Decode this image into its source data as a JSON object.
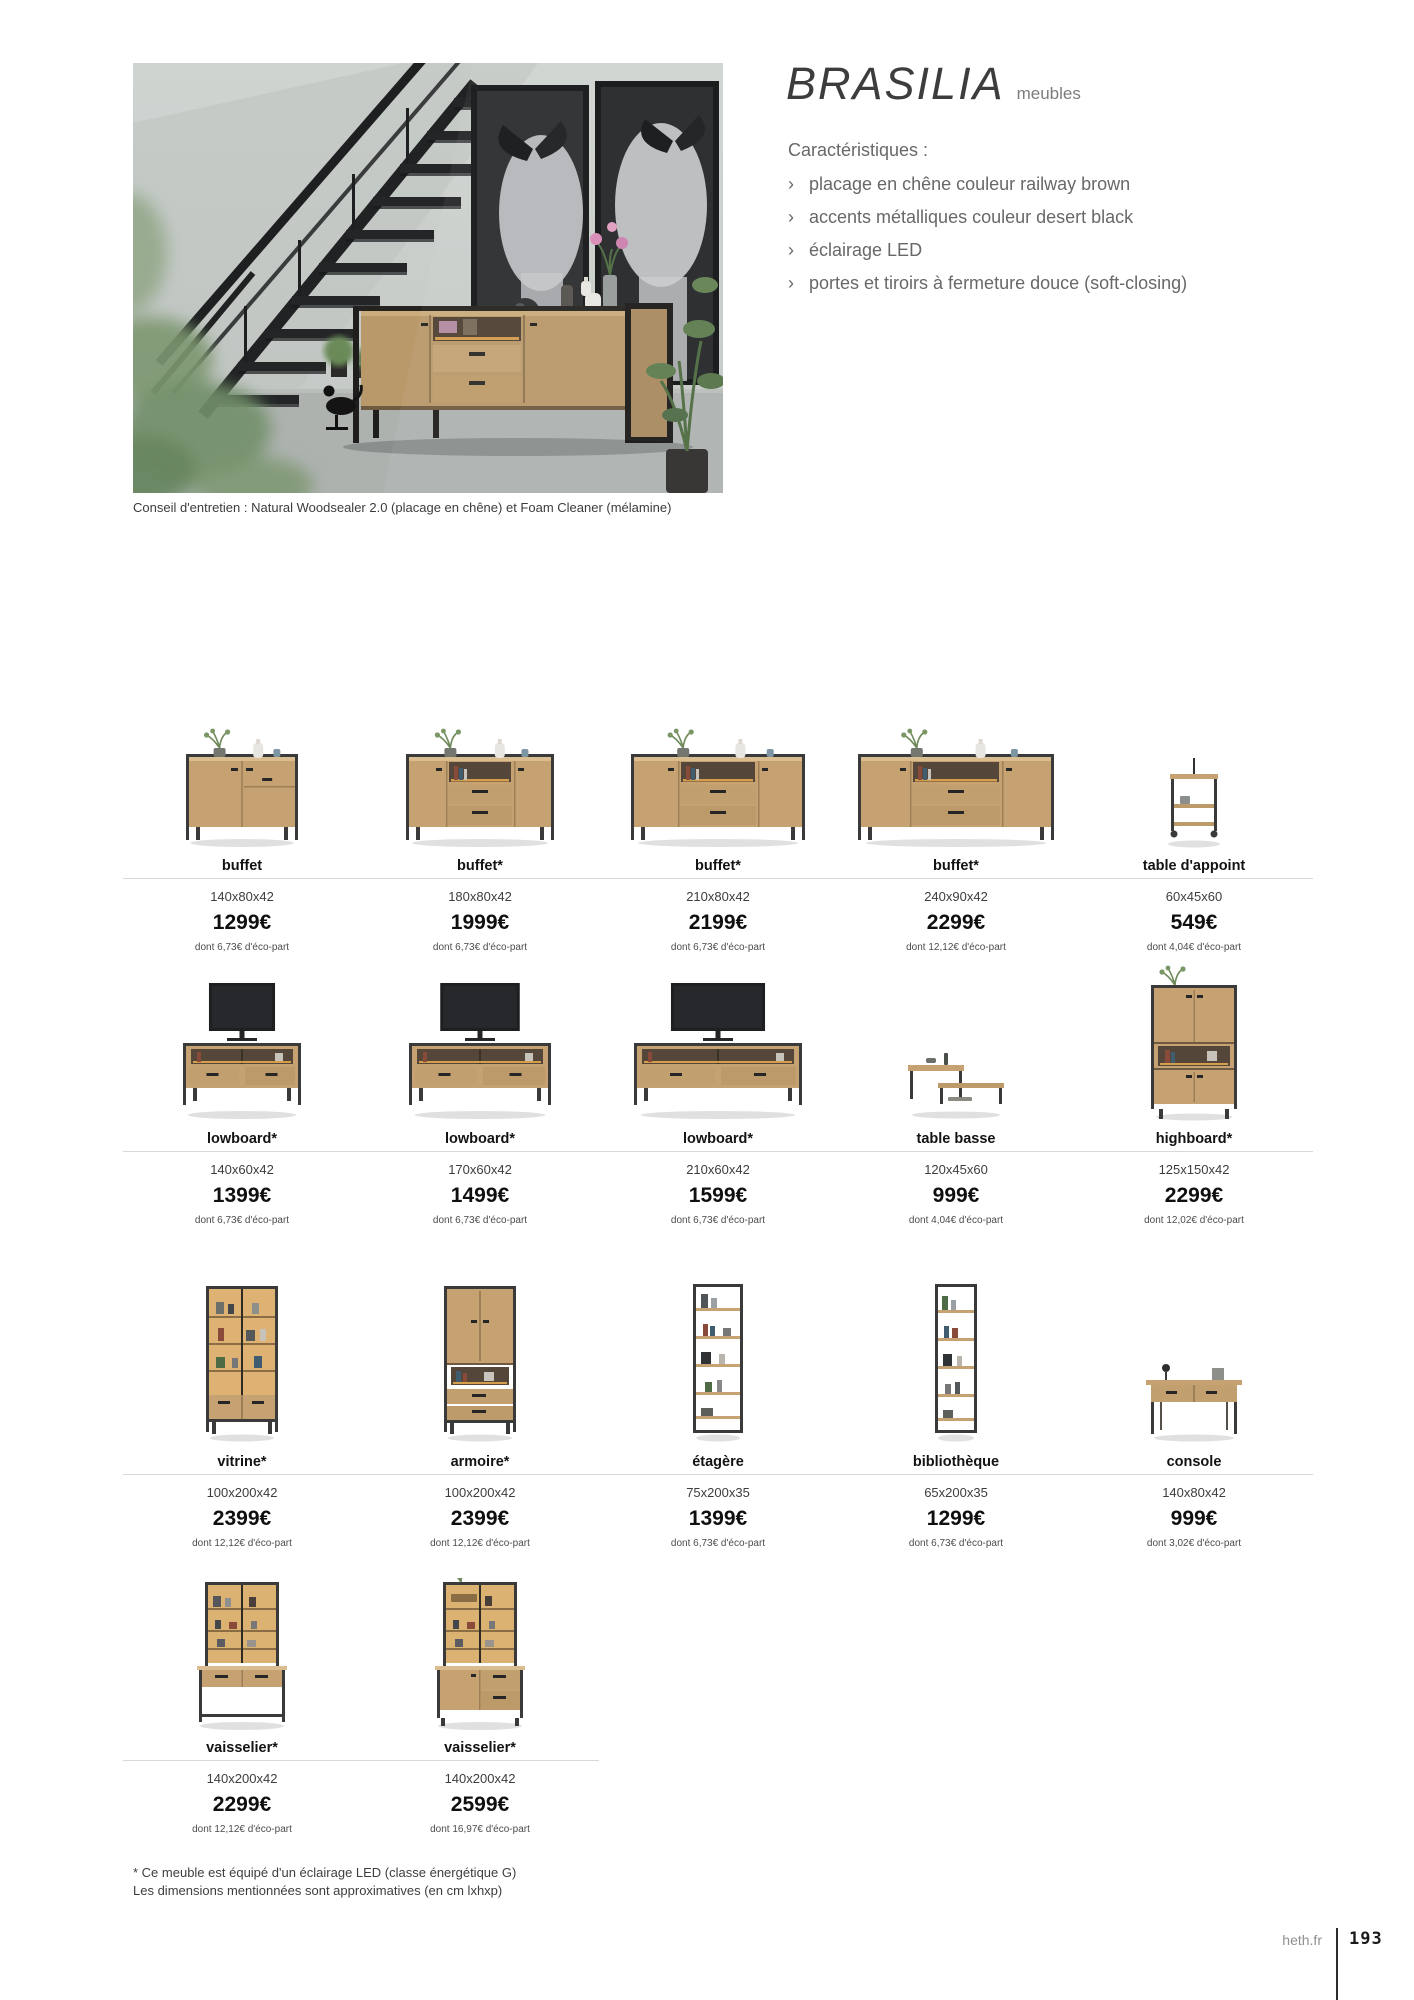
{
  "header": {
    "title": "BRASILIA",
    "subtitle": "meubles",
    "features_title": "Caractéristiques :",
    "bullet_char": "›",
    "features": [
      "placage en chêne couleur railway brown",
      "accents métalliques couleur desert black",
      "éclairage LED",
      "portes et tiroirs à fermeture douce (soft-closing)"
    ],
    "caption": "Conseil d'entretien : Natural Woodsealer 2.0 (placage en chêne) et Foam Cleaner (mélamine)"
  },
  "colors": {
    "wood": "#c6a171",
    "metal": "#3a3a3a",
    "glow": "#e3a74f",
    "divider": "#d8d8d8"
  },
  "products": {
    "rows": [
      {
        "items": [
          {
            "name": "buffet",
            "dims": "140x80x42",
            "price": "1299€",
            "eco": "dont 6,73€ d'éco-part",
            "image": "buffet-2p"
          },
          {
            "name": "buffet*",
            "dims": "180x80x42",
            "price": "1999€",
            "eco": "dont 6,73€ d'éco-part",
            "image": "buffet-3p"
          },
          {
            "name": "buffet*",
            "dims": "210x80x42",
            "price": "2199€",
            "eco": "dont 6,73€ d'éco-part",
            "image": "buffet-3p-l"
          },
          {
            "name": "buffet*",
            "dims": "240x90x42",
            "price": "2299€",
            "eco": "dont 12,12€ d'éco-part",
            "image": "buffet-3p-xl"
          },
          {
            "name": "table d'appoint",
            "dims": "60x45x60",
            "price": "549€",
            "eco": "dont 4,04€ d'éco-part",
            "image": "appoint"
          }
        ]
      },
      {
        "items": [
          {
            "name": "lowboard*",
            "dims": "140x60x42",
            "price": "1399€",
            "eco": "dont 6,73€ d'éco-part",
            "image": "lowboard-s"
          },
          {
            "name": "lowboard*",
            "dims": "170x60x42",
            "price": "1499€",
            "eco": "dont 6,73€ d'éco-part",
            "image": "lowboard-m"
          },
          {
            "name": "lowboard*",
            "dims": "210x60x42",
            "price": "1599€",
            "eco": "dont 6,73€ d'éco-part",
            "image": "lowboard-l"
          },
          {
            "name": "table basse",
            "dims": "120x45x60",
            "price": "999€",
            "eco": "dont 4,04€ d'éco-part",
            "image": "table-basse"
          },
          {
            "name": "highboard*",
            "dims": "125x150x42",
            "price": "2299€",
            "eco": "dont 12,02€ d'éco-part",
            "image": "highboard"
          }
        ]
      },
      {
        "items": [
          {
            "name": "vitrine*",
            "dims": "100x200x42",
            "price": "2399€",
            "eco": "dont 12,12€ d'éco-part",
            "image": "vitrine"
          },
          {
            "name": "armoire*",
            "dims": "100x200x42",
            "price": "2399€",
            "eco": "dont 12,12€ d'éco-part",
            "image": "armoire"
          },
          {
            "name": "étagère",
            "dims": "75x200x35",
            "price": "1399€",
            "eco": "dont 6,73€ d'éco-part",
            "image": "etagere"
          },
          {
            "name": "bibliothèque",
            "dims": "65x200x35",
            "price": "1299€",
            "eco": "dont 6,73€ d'éco-part",
            "image": "bibliotheque"
          },
          {
            "name": "console",
            "dims": "140x80x42",
            "price": "999€",
            "eco": "dont 3,02€ d'éco-part",
            "image": "console"
          }
        ]
      },
      {
        "items": [
          {
            "name": "vaisselier*",
            "dims": "140x200x42",
            "price": "2299€",
            "eco": "dont 12,12€ d'éco-part",
            "image": "vaisselier-1"
          },
          {
            "name": "vaisselier*",
            "dims": "140x200x42",
            "price": "2599€",
            "eco": "dont 16,97€ d'éco-part",
            "image": "vaisselier-2"
          }
        ]
      }
    ]
  },
  "footnotes": [
    "* Ce meuble est équipé d'un éclairage LED (classe énergétique G)",
    "Les dimensions mentionnées sont approximatives (en cm lxhxp)"
  ],
  "footer": {
    "site": "heth.fr",
    "page": "193"
  }
}
